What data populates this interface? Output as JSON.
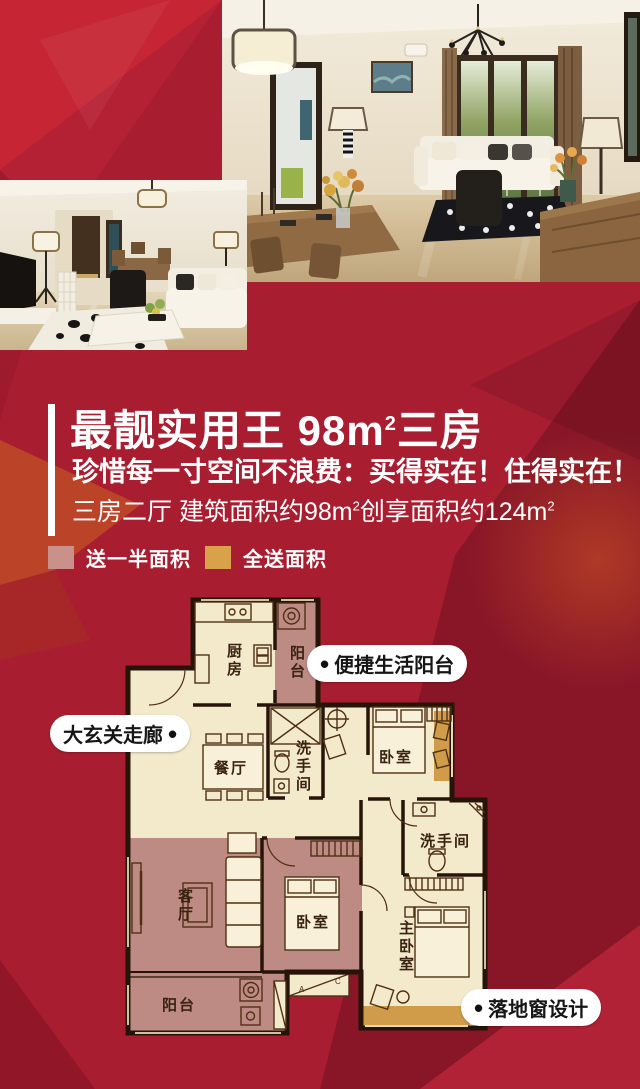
{
  "header": {
    "title_part1": "最靓实用王 98m",
    "title_sup": "2",
    "title_part2": "三房",
    "subtitle": "珍惜每一寸空间不浪费：买得实在！住得实在！",
    "spec_part1": "三房二厅 建筑面积约98m",
    "spec_sup1": "2",
    "spec_part2": "创享面积约124m",
    "spec_sup2": "2"
  },
  "legend": {
    "items": [
      {
        "label": "送一半面积",
        "color": "#c9908c"
      },
      {
        "label": "全送面积",
        "color": "#d9a24a"
      }
    ]
  },
  "callouts": {
    "bullet": "•",
    "balcony": "便捷生活阳台",
    "hallway": "大玄关走廊",
    "window": "落地窗设计"
  },
  "floorplan": {
    "rooms": [
      {
        "id": "kitchen",
        "label": "厨房"
      },
      {
        "id": "balcony-top",
        "label": "阳台"
      },
      {
        "id": "dining",
        "label": "餐厅"
      },
      {
        "id": "bath-1",
        "label": "洗手间"
      },
      {
        "id": "bedroom-1",
        "label": "卧室"
      },
      {
        "id": "bath-2",
        "label": "洗手间"
      },
      {
        "id": "living",
        "label": "客厅"
      },
      {
        "id": "bedroom-2",
        "label": "卧室"
      },
      {
        "id": "master-bedroom",
        "label": "主卧室"
      },
      {
        "id": "balcony-bottom",
        "label": "阳台"
      }
    ],
    "ac_letters": [
      "A",
      "C"
    ],
    "colors": {
      "wall": "#261409",
      "floor": "#f3e9cb",
      "half_gift_area": "#bd8b84",
      "full_gift_area": "#d09c4a"
    }
  },
  "background": {
    "base_red": "#a81e30"
  }
}
